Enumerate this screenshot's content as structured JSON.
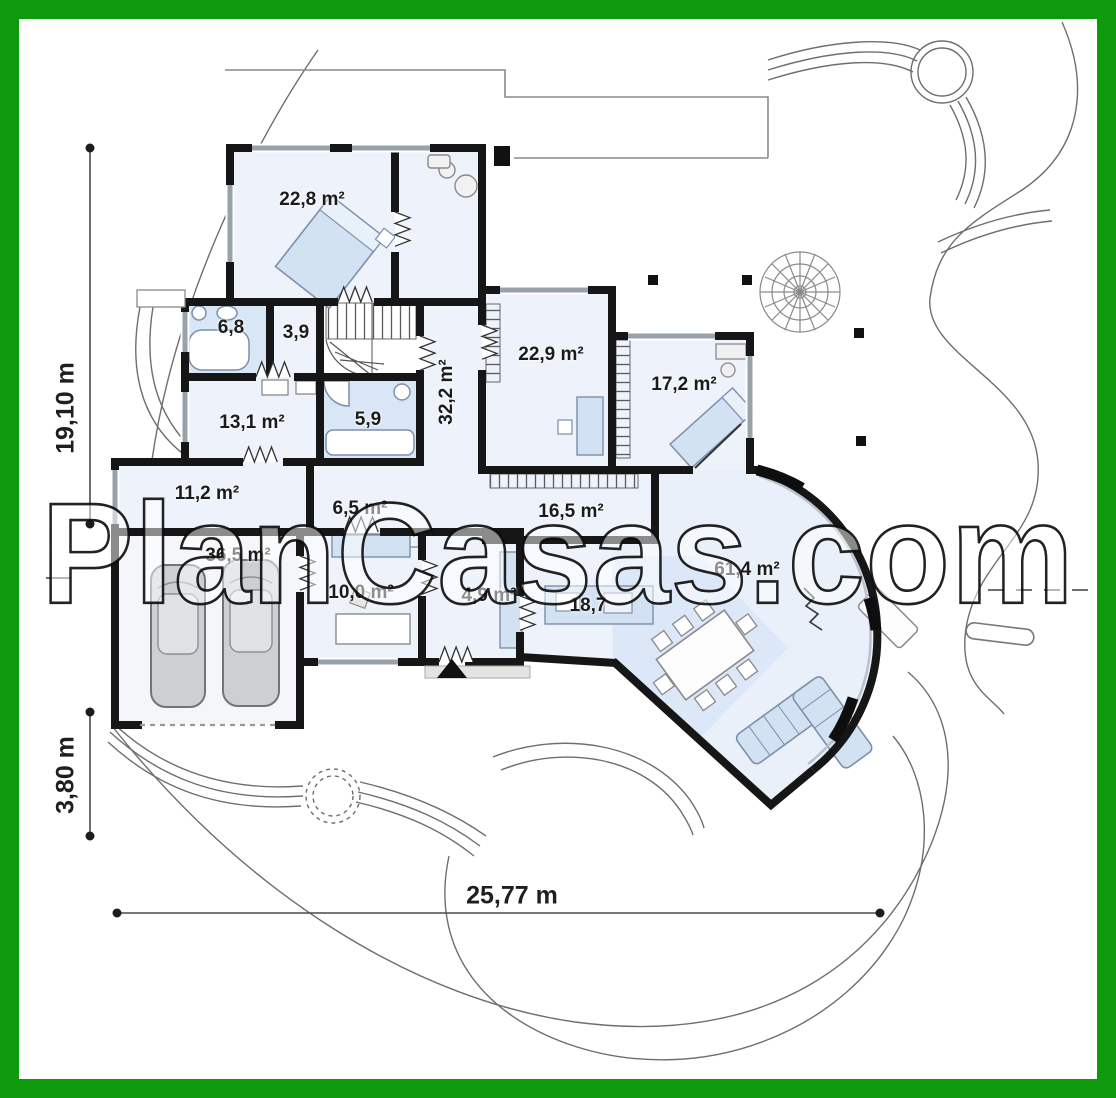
{
  "watermark": "PlanCasas.com",
  "colors": {
    "border_green": "#0d9b0d",
    "wall_black": "#161616",
    "floor_blue": "#edf2fb",
    "fixture_blue": "#d3e2f3",
    "window_gray": "#98a2ab"
  },
  "rooms": [
    {
      "id": "bedroom-1",
      "label": "22,8 m²",
      "x": 312,
      "y": 200,
      "rot": 0
    },
    {
      "id": "bath-1",
      "label": "6,8",
      "x": 231,
      "y": 328,
      "rot": 0
    },
    {
      "id": "wardrobe",
      "label": "3,9",
      "x": 296,
      "y": 333,
      "rot": 0
    },
    {
      "id": "hallway",
      "label": "32,2 m²",
      "x": 447,
      "y": 392,
      "rot": -90
    },
    {
      "id": "bedroom-2",
      "label": "22,9 m²",
      "x": 551,
      "y": 355,
      "rot": 0
    },
    {
      "id": "bedroom-3",
      "label": "17,2 m²",
      "x": 684,
      "y": 385,
      "rot": 0
    },
    {
      "id": "room-13",
      "label": "13,1 m²",
      "x": 252,
      "y": 423,
      "rot": 0
    },
    {
      "id": "bath-2",
      "label": "5,9",
      "x": 368,
      "y": 420,
      "rot": 0
    },
    {
      "id": "entry-hall",
      "label": "11,2 m²",
      "x": 207,
      "y": 494,
      "rot": 0
    },
    {
      "id": "closet-hall",
      "label": "6,5 m²",
      "x": 360,
      "y": 509,
      "rot": 0
    },
    {
      "id": "hall-open",
      "label": "16,5 m²",
      "x": 571,
      "y": 512,
      "rot": 0
    },
    {
      "id": "garage",
      "label": "36,5 m²",
      "x": 238,
      "y": 556,
      "rot": 0
    },
    {
      "id": "utility",
      "label": "10,0 m²",
      "x": 361,
      "y": 593,
      "rot": 0
    },
    {
      "id": "vestibule",
      "label": "4,9 m²",
      "x": 489,
      "y": 596,
      "rot": 0
    },
    {
      "id": "kitchen",
      "label": "18,7",
      "x": 588,
      "y": 606,
      "rot": 0
    },
    {
      "id": "living-room",
      "label": "61,4 m²",
      "x": 747,
      "y": 570,
      "rot": 0
    }
  ],
  "dimensions": [
    {
      "id": "total-height",
      "label": "19,10 m",
      "x": 66,
      "y": 408,
      "rot": -90
    },
    {
      "id": "garage-offset",
      "label": "3,80 m",
      "x": 66,
      "y": 775,
      "rot": -90
    },
    {
      "id": "total-width",
      "label": "25,77 m",
      "x": 512,
      "y": 896,
      "rot": 0
    }
  ]
}
